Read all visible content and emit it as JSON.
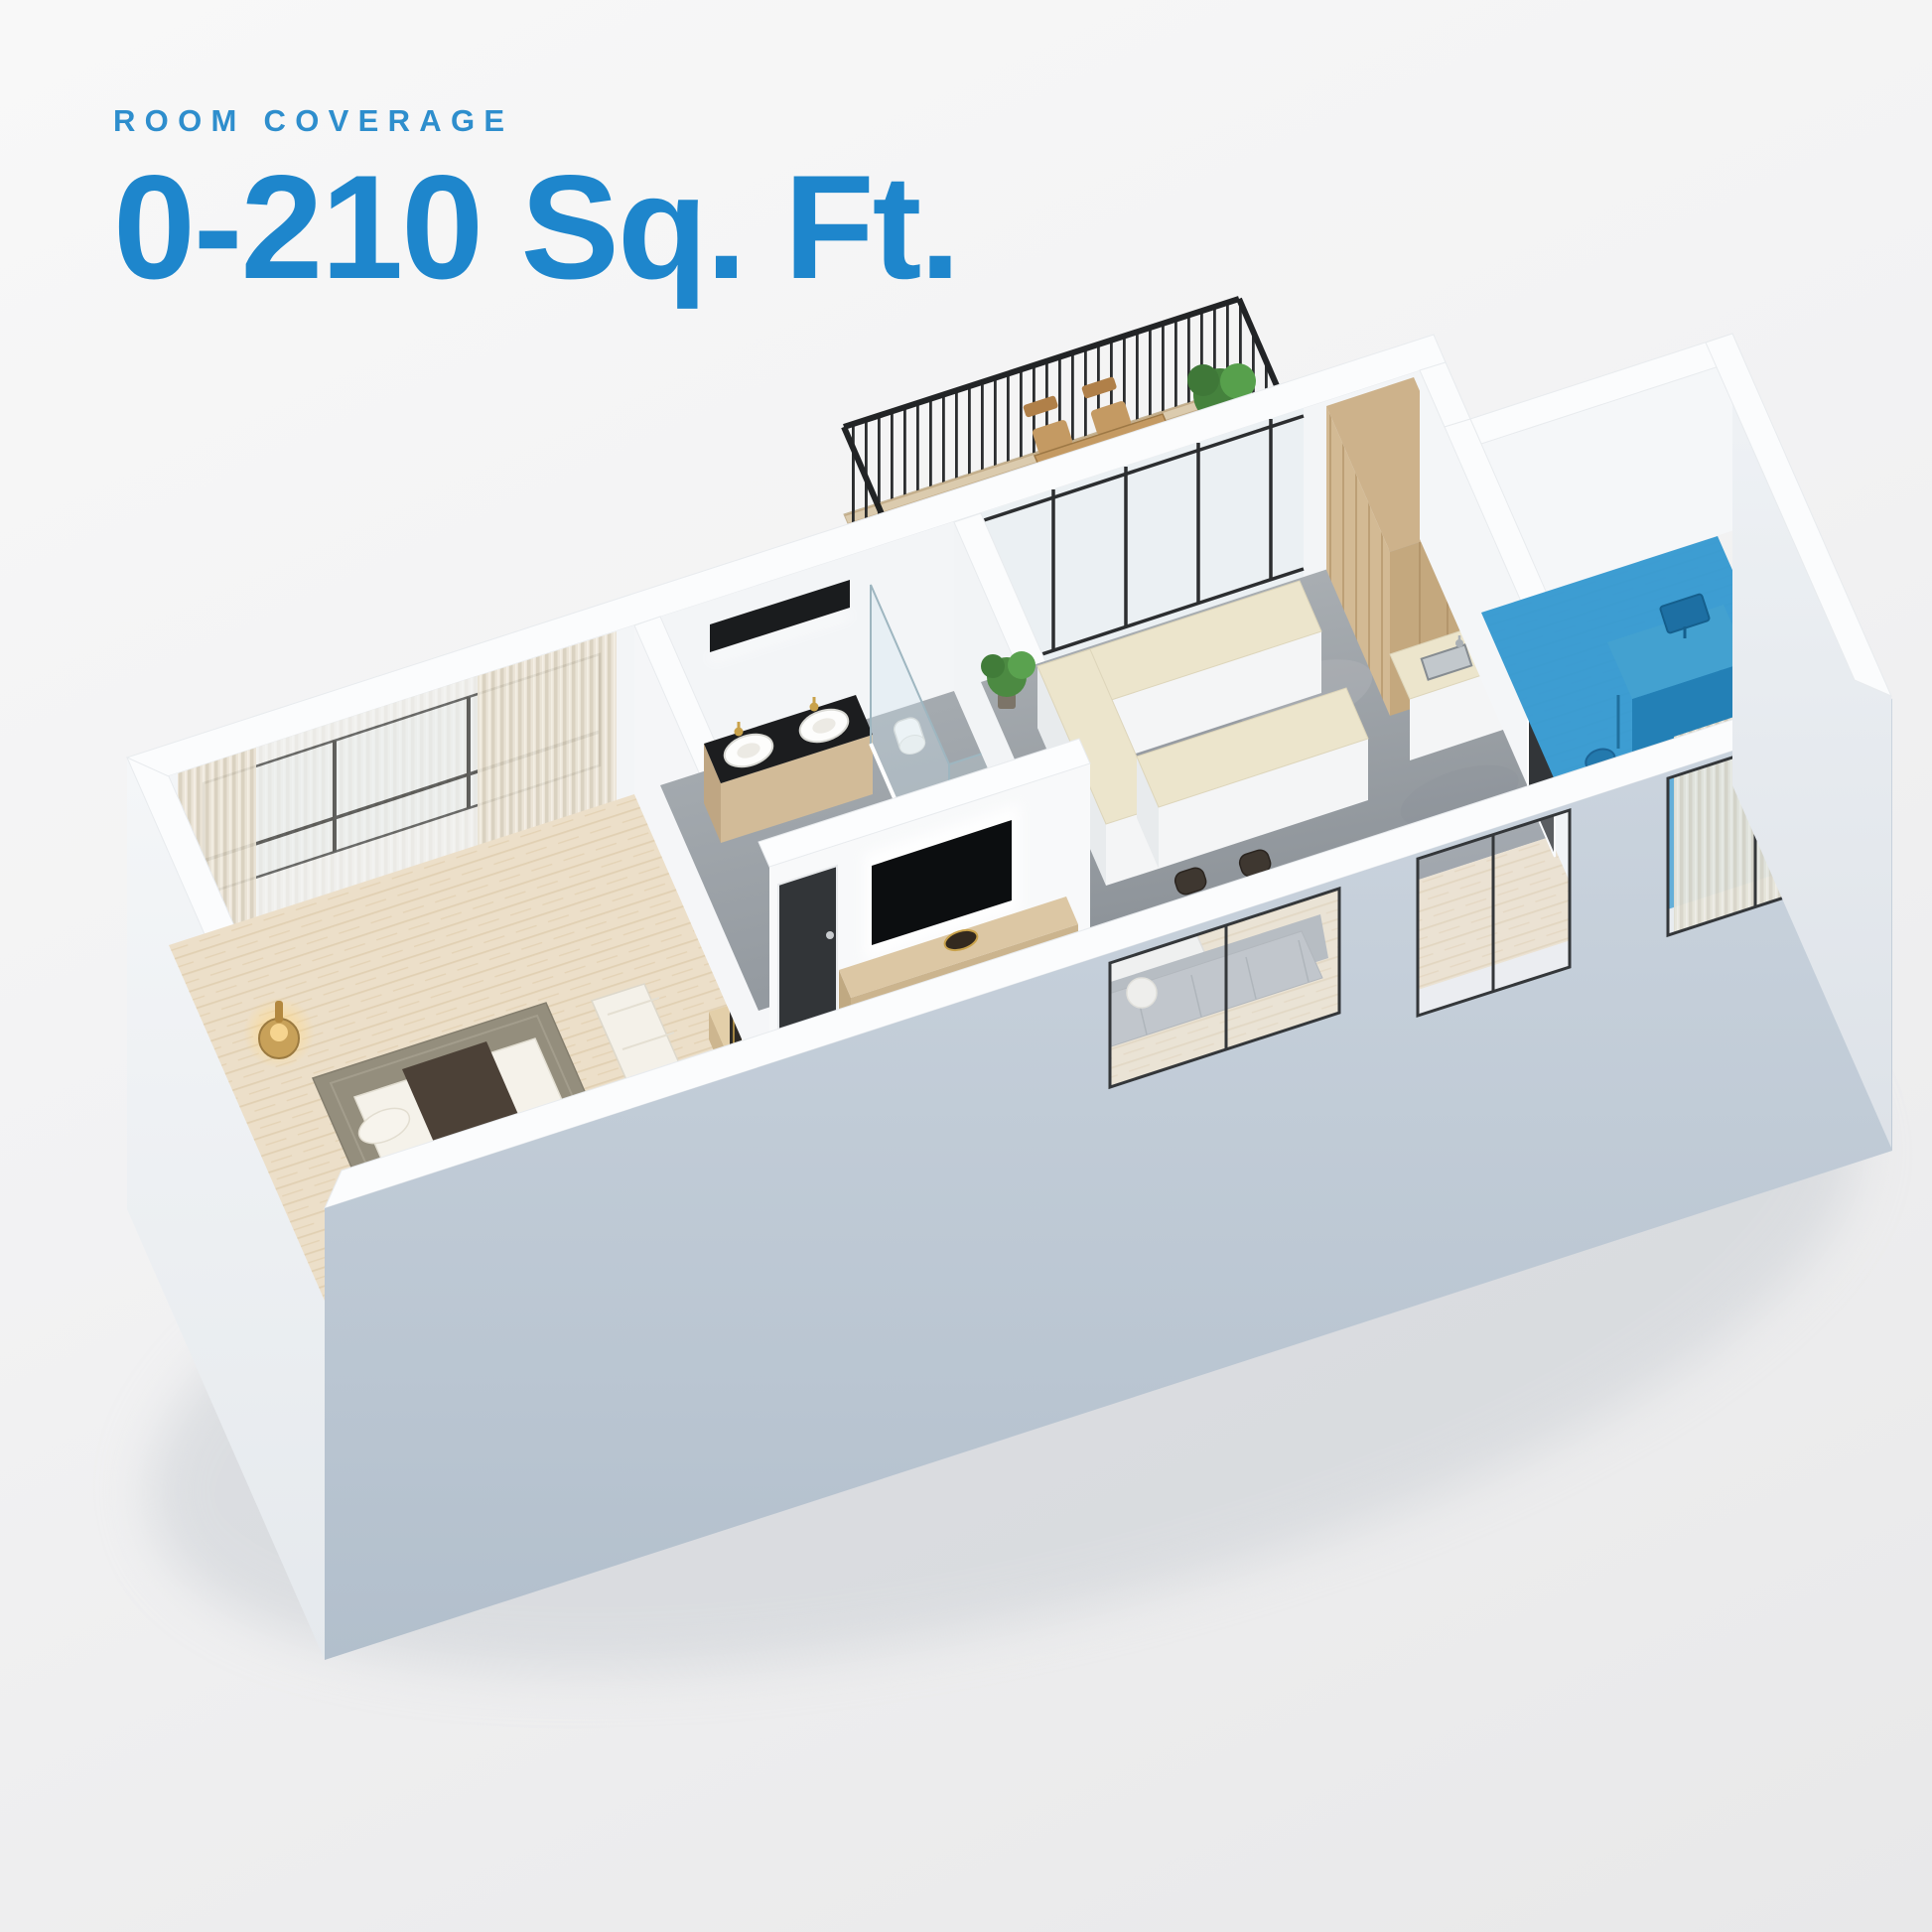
{
  "header": {
    "eyebrow": "ROOM COVERAGE",
    "headline": "0-210 Sq. Ft."
  },
  "colors": {
    "eyebrow_blue": "#2e8ecd",
    "accent_blue": "#1e86cc",
    "highlight_blue": "#2e97d3",
    "highlight_furniture_blue": "#2380b6",
    "wall_white": "#fbfcfd",
    "front_wall_gray": "#b8c3d0",
    "wood_floor": "#ecdfc9",
    "concrete_floor": "#9aa1a7",
    "balcony_deck": "#dbcbae",
    "counter_top": "#ece5cc",
    "plant_green": "#4c8a42",
    "door_dark": "#323538",
    "railing_black": "#212325",
    "background": "#f0f0f1"
  },
  "floorplan": {
    "highlighted_room": "home-office",
    "rooms": [
      "bedroom",
      "bathroom",
      "kitchen-dining",
      "living-room",
      "home-office",
      "balcony"
    ]
  }
}
